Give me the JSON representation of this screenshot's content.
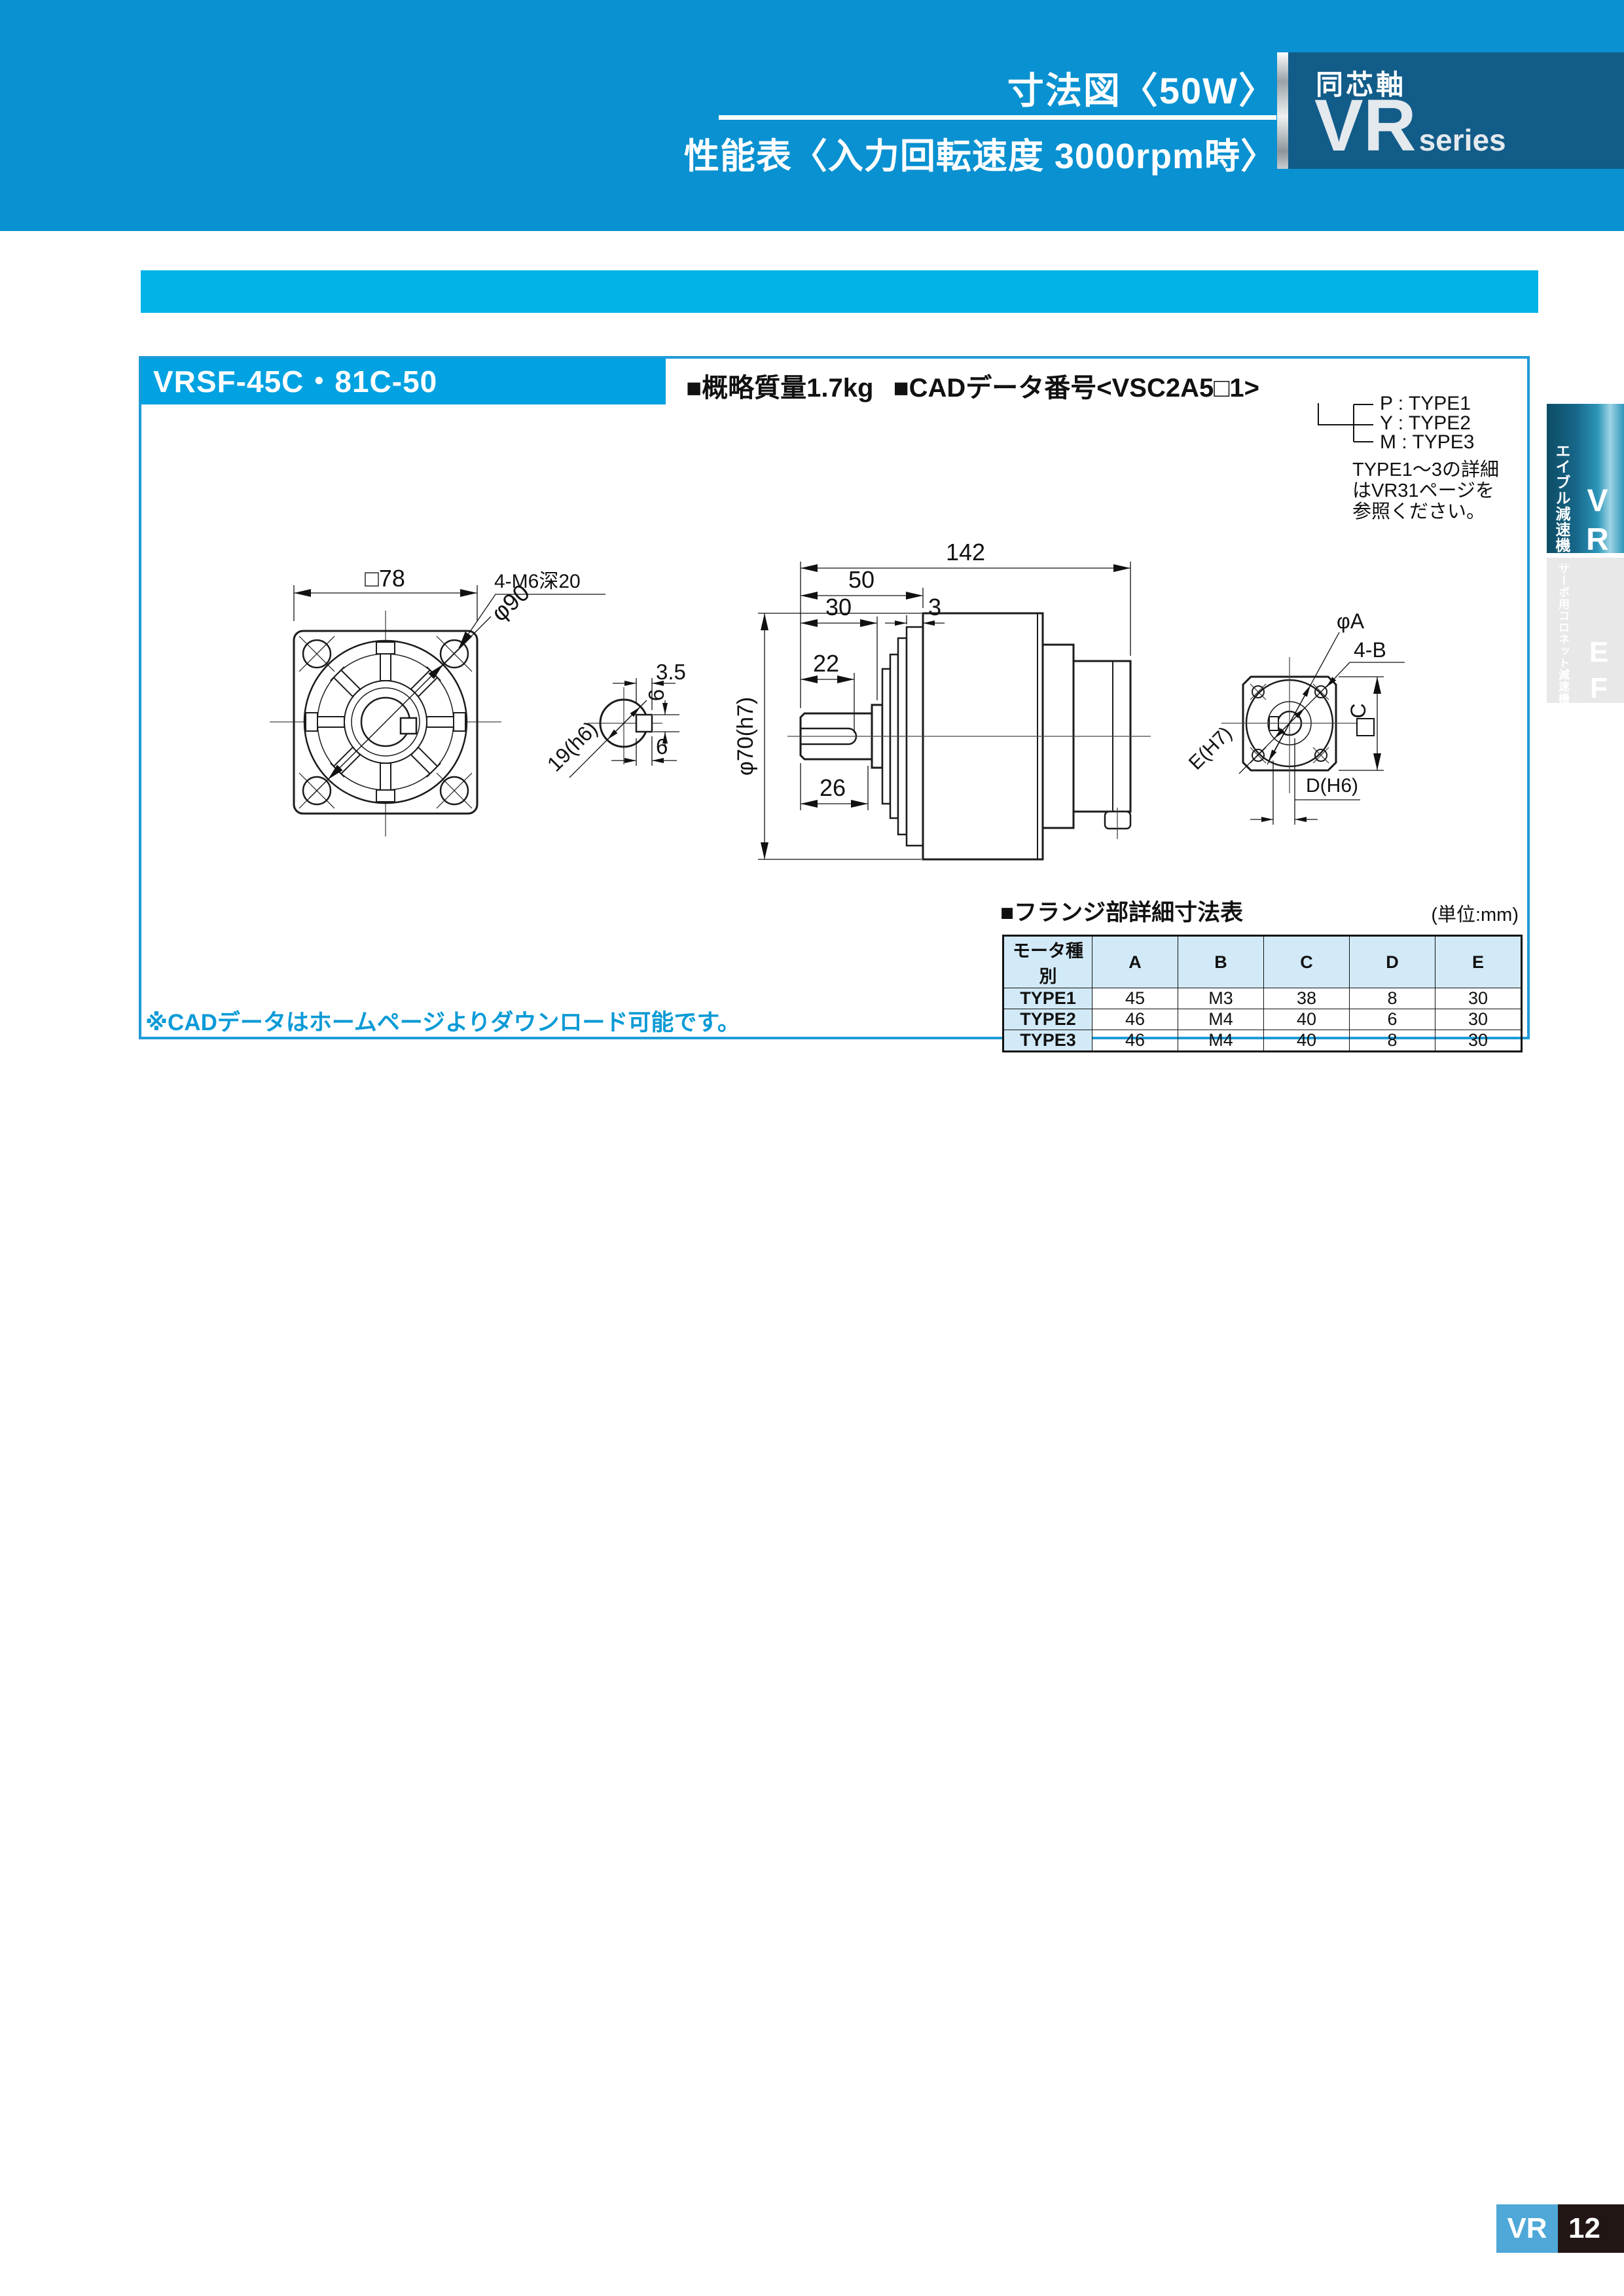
{
  "header": {
    "title_line1": "寸法図〈50W〉",
    "title_line2": "性能表〈入力回転速度 3000rpm時〉",
    "series_box": {
      "category": "同芯軸",
      "code": "VR",
      "suffix": "series"
    }
  },
  "product": {
    "model": "VRSF-45C・81C-50",
    "mass": "■概略質量1.7kg",
    "cad_number": "■CADデータ番号<VSC2A5□1>",
    "type_options": [
      "P : TYPE1",
      "Y : TYPE2",
      "M : TYPE3"
    ],
    "type_note": [
      "TYPE1〜3の詳細",
      "はVR31ページを",
      "参照ください。"
    ]
  },
  "drawing": {
    "front": {
      "side": "□78",
      "holes": "4-M6深20",
      "bolt_circle": "φ90"
    },
    "shaft_section": {
      "key_offset": "3.5",
      "key_height": "6",
      "key_width": "6",
      "diameter": "19(h6)"
    },
    "side": {
      "overall": "142",
      "front_len": "50",
      "shaft_step": "30",
      "gap": "3",
      "key_len": "22",
      "shaft_len": "26",
      "body_dia": "φ70(h7)"
    },
    "rear": {
      "pilot": "φA",
      "holes": "4-B",
      "square": "C",
      "spigot": "E(H7)",
      "bore": "D(H6)"
    }
  },
  "flange_table": {
    "title": "■フランジ部詳細寸法表",
    "unit": "(単位:mm)",
    "columns": [
      "モータ種別",
      "A",
      "B",
      "C",
      "D",
      "E"
    ],
    "rows": [
      [
        "TYPE1",
        "45",
        "M3",
        "38",
        "8",
        "30"
      ],
      [
        "TYPE2",
        "46",
        "M4",
        "40",
        "6",
        "30"
      ],
      [
        "TYPE3",
        "46",
        "M4",
        "40",
        "8",
        "30"
      ]
    ]
  },
  "footnote": "※CADデータはホームページよりダウンロード可能です。",
  "sidebar": {
    "tab_vr": {
      "label": "エイブル減速機",
      "code": "VR"
    },
    "tab_ef": {
      "label": "サーボ用コロネット減速機",
      "code": "EF"
    }
  },
  "footer": {
    "series": "VR",
    "page": "12"
  },
  "colors": {
    "band_blue": "#0991d1",
    "cyan": "#00b4e8",
    "series_box_blue": "#125c89",
    "box_border_blue": "#1f9bd7",
    "model_block_cyan": "#00a2e2",
    "note_blue": "#0a9ad6",
    "footer_vr_bg": "#4fa8d7",
    "footer_page_bg": "#221614",
    "table_header_bg": "#d2eaf8"
  }
}
